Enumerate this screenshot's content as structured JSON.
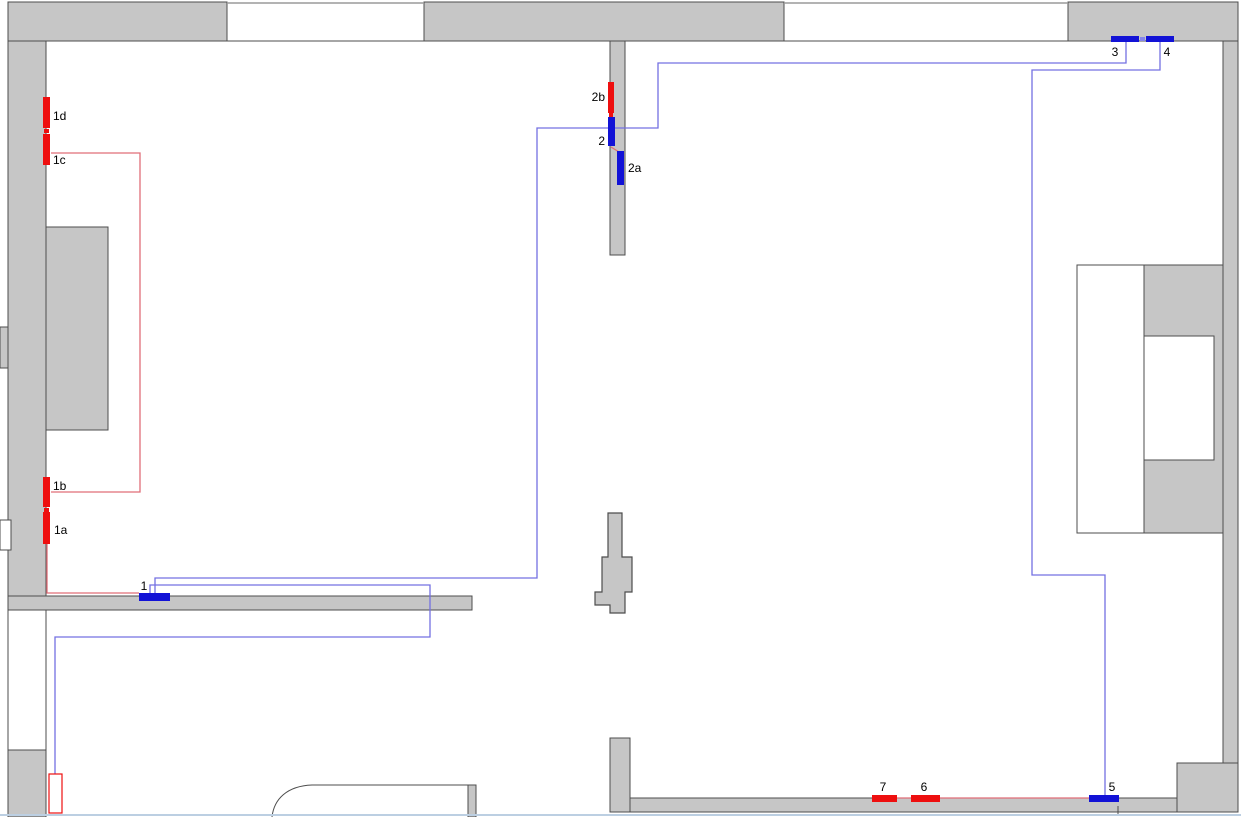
{
  "diagram": {
    "kind": "floor-plan-heating-circuit",
    "colors": {
      "wall_fill": "#c6c6c6",
      "wall_stroke": "#4d4d4d",
      "window_stroke": "#9a9a9a",
      "supply_line_blue": "#7470e2",
      "return_line_red": "#e06e78",
      "marker_red": "#ee0f0f",
      "marker_blue": "#1212d6",
      "tick_light_blue": "#8585ea",
      "label_color": "#000000",
      "viewport_edge": "#bccfe2",
      "white": "#ffffff"
    },
    "walls": [
      {
        "name": "wall-top-left",
        "type": "rect",
        "x": 8,
        "y": 2,
        "w": 219,
        "h": 39,
        "fill": "wall"
      },
      {
        "name": "wall-top-middle",
        "type": "rect",
        "x": 424,
        "y": 2,
        "w": 360,
        "h": 39,
        "fill": "wall"
      },
      {
        "name": "wall-top-right",
        "type": "rect",
        "x": 1068,
        "y": 2,
        "w": 170,
        "h": 39,
        "fill": "wall"
      },
      {
        "name": "wall-left",
        "type": "rect",
        "x": 8,
        "y": 41,
        "w": 38,
        "h": 569,
        "fill": "wall"
      },
      {
        "name": "wall-left-bump",
        "type": "rect",
        "x": 46,
        "y": 227,
        "w": 62,
        "h": 203,
        "fill": "wall"
      },
      {
        "name": "wall-left-pier",
        "type": "rect",
        "x": 0,
        "y": 327,
        "w": 8,
        "h": 41,
        "fill": "wall"
      },
      {
        "name": "wall-bottom-left",
        "type": "rect",
        "x": 8,
        "y": 596,
        "w": 464,
        "h": 14,
        "fill": "wall"
      },
      {
        "name": "wall-left-lower-cavity",
        "type": "rect",
        "x": 8,
        "y": 610,
        "w": 38,
        "h": 140,
        "fill": "white"
      },
      {
        "name": "wall-left-lower",
        "type": "rect",
        "x": 8,
        "y": 750,
        "w": 38,
        "h": 67,
        "fill": "wall"
      },
      {
        "name": "wall-middle-top",
        "type": "rect",
        "x": 610,
        "y": 41,
        "w": 15,
        "h": 214,
        "fill": "wall"
      },
      {
        "name": "wall-middle-bottom",
        "type": "rect",
        "x": 610,
        "y": 738,
        "w": 20,
        "h": 74,
        "fill": "wall"
      },
      {
        "name": "wall-bottom",
        "type": "rect",
        "x": 630,
        "y": 798,
        "w": 547,
        "h": 14,
        "fill": "wall"
      },
      {
        "name": "wall-bottom-right-block",
        "type": "rect",
        "x": 1177,
        "y": 763,
        "w": 61,
        "h": 49,
        "fill": "wall"
      },
      {
        "name": "wall-right",
        "type": "rect",
        "x": 1223,
        "y": 41,
        "w": 15,
        "h": 722,
        "fill": "wall"
      },
      {
        "name": "wall-right-protrusion",
        "type": "rect",
        "x": 1144,
        "y": 265,
        "w": 79,
        "h": 268,
        "fill": "wall"
      },
      {
        "name": "niche-left",
        "type": "rect",
        "x": 1077,
        "y": 265,
        "w": 67,
        "h": 268,
        "fill": "white"
      },
      {
        "name": "niche-inner",
        "type": "rect",
        "x": 1144,
        "y": 336,
        "w": 70,
        "h": 124,
        "fill": "white"
      },
      {
        "name": "left-wall-opening",
        "type": "rect",
        "x": 0,
        "y": 520,
        "w": 11,
        "h": 30,
        "fill": "white"
      },
      {
        "name": "pillar-center",
        "type": "polygon",
        "points": "608,513 622,513 622,557 632,557 632,592 625,592 625,613 610,613 610,605 595,605 595,592 602,592 602,557 608,557"
      },
      {
        "name": "counter-end",
        "type": "rect",
        "x": 468,
        "y": 785,
        "w": 8,
        "h": 32,
        "fill": "wall"
      },
      {
        "name": "counter-edge",
        "type": "path",
        "d": "M272,817 C274,799 287,786 312,785 L468,785"
      }
    ],
    "window_lines": [
      {
        "name": "window-top-1-outer",
        "x1": 227,
        "y1": 3,
        "x2": 424,
        "y2": 3,
        "stroke": "window_stroke",
        "w": 1.5
      },
      {
        "name": "window-top-1-inner",
        "x1": 227,
        "y1": 41,
        "x2": 424,
        "y2": 41,
        "stroke": "wall_stroke",
        "w": 1
      },
      {
        "name": "window-top-2-outer",
        "x1": 784,
        "y1": 3,
        "x2": 1068,
        "y2": 3,
        "stroke": "window_stroke",
        "w": 1.5
      },
      {
        "name": "window-top-2-inner",
        "x1": 784,
        "y1": 41,
        "x2": 1068,
        "y2": 41,
        "stroke": "wall_stroke",
        "w": 1
      },
      {
        "name": "door-tick",
        "x1": 1118,
        "y1": 806,
        "x2": 1118,
        "y2": 814,
        "stroke": "wall_stroke",
        "w": 1
      },
      {
        "name": "viewport-bottom-edge",
        "x1": 0,
        "y1": 815,
        "x2": 1241,
        "y2": 815,
        "stroke": "viewport_edge",
        "w": 2
      }
    ],
    "pipes": [
      {
        "name": "pipe-blue-3-to-1",
        "color": "blue",
        "points": [
          [
            1126,
            42
          ],
          [
            1126,
            63
          ],
          [
            658,
            63
          ],
          [
            658,
            128
          ],
          [
            537,
            128
          ],
          [
            537,
            578
          ],
          [
            155,
            578
          ],
          [
            155,
            593
          ]
        ]
      },
      {
        "name": "pipe-blue-4-to-5",
        "color": "blue",
        "points": [
          [
            1160,
            42
          ],
          [
            1160,
            70
          ],
          [
            1032,
            70
          ],
          [
            1032,
            575
          ],
          [
            1105,
            575
          ],
          [
            1105,
            795
          ]
        ]
      },
      {
        "name": "pipe-blue-1-to-boiler",
        "color": "blue",
        "points": [
          [
            150,
            593
          ],
          [
            150,
            585
          ],
          [
            430,
            585
          ],
          [
            430,
            637
          ],
          [
            55,
            637
          ],
          [
            55,
            774
          ]
        ]
      },
      {
        "name": "pipe-red-1c-to-1b",
        "color": "red",
        "points": [
          [
            51,
            153
          ],
          [
            140,
            153
          ],
          [
            140,
            492
          ],
          [
            51,
            492
          ]
        ]
      },
      {
        "name": "pipe-red-1a-to-1",
        "color": "red",
        "points": [
          [
            47,
            544
          ],
          [
            47,
            593
          ],
          [
            139,
            593
          ]
        ]
      },
      {
        "name": "pipe-red-7-6-to-5",
        "color": "red",
        "points": [
          [
            872,
            798
          ],
          [
            1089,
            798
          ]
        ]
      },
      {
        "name": "pipe-red-2-to-2a",
        "color": "red",
        "points": [
          [
            611,
            147
          ],
          [
            619,
            152
          ]
        ]
      }
    ],
    "connector_ticks": [
      {
        "name": "valve-tick-1d-1c",
        "x": 44,
        "y": 129,
        "w": 5,
        "h": 4,
        "color": "marker_red"
      },
      {
        "name": "valve-tick-1b-1a",
        "x": 44,
        "y": 508,
        "w": 5,
        "h": 4,
        "color": "marker_red"
      },
      {
        "name": "valve-tick-2b-2",
        "x": 609,
        "y": 113,
        "w": 4,
        "h": 4,
        "color": "marker_red"
      },
      {
        "name": "valve-tick-3-4",
        "x": 1140,
        "y": 37,
        "w": 5,
        "h": 4,
        "color": "tick_light_blue"
      }
    ],
    "markers": [
      {
        "id": "1d",
        "label": "1d",
        "color": "red",
        "x": 43,
        "y": 97,
        "w": 7,
        "h": 31,
        "lx": 53,
        "ly": 120,
        "anchor": "start"
      },
      {
        "id": "1c",
        "label": "1c",
        "color": "red",
        "x": 43,
        "y": 134,
        "w": 7,
        "h": 31,
        "lx": 53,
        "ly": 164,
        "anchor": "start"
      },
      {
        "id": "1b",
        "label": "1b",
        "color": "red",
        "x": 43,
        "y": 477,
        "w": 7,
        "h": 30,
        "lx": 53,
        "ly": 490,
        "anchor": "start"
      },
      {
        "id": "1a",
        "label": "1a",
        "color": "red",
        "x": 43,
        "y": 512,
        "w": 7,
        "h": 32,
        "lx": 54,
        "ly": 534,
        "anchor": "start"
      },
      {
        "id": "1",
        "label": "1",
        "color": "blue",
        "x": 139,
        "y": 593,
        "w": 31,
        "h": 8,
        "lx": 144,
        "ly": 590,
        "anchor": "middle"
      },
      {
        "id": "2b",
        "label": "2b",
        "color": "red",
        "x": 608,
        "y": 82,
        "w": 6,
        "h": 31,
        "lx": 605,
        "ly": 101,
        "anchor": "end"
      },
      {
        "id": "2",
        "label": "2",
        "color": "blue",
        "x": 608,
        "y": 117,
        "w": 7,
        "h": 29,
        "lx": 605,
        "ly": 145,
        "anchor": "end"
      },
      {
        "id": "2a",
        "label": "2a",
        "color": "blue",
        "x": 617,
        "y": 151,
        "w": 7,
        "h": 34,
        "lx": 628,
        "ly": 172,
        "anchor": "start"
      },
      {
        "id": "3",
        "label": "3",
        "color": "blue",
        "x": 1111,
        "y": 36,
        "w": 28,
        "h": 6,
        "lx": 1115,
        "ly": 56,
        "anchor": "middle"
      },
      {
        "id": "4",
        "label": "4",
        "color": "blue",
        "x": 1146,
        "y": 36,
        "w": 28,
        "h": 6,
        "lx": 1167,
        "ly": 56,
        "anchor": "middle"
      },
      {
        "id": "5",
        "label": "5",
        "color": "blue",
        "x": 1089,
        "y": 795,
        "w": 30,
        "h": 7,
        "lx": 1112,
        "ly": 791,
        "anchor": "middle"
      },
      {
        "id": "6",
        "label": "6",
        "color": "red",
        "x": 911,
        "y": 795,
        "w": 29,
        "h": 7,
        "lx": 924,
        "ly": 791,
        "anchor": "middle"
      },
      {
        "id": "7",
        "label": "7",
        "color": "red",
        "x": 872,
        "y": 795,
        "w": 25,
        "h": 7,
        "lx": 883,
        "ly": 791,
        "anchor": "middle"
      }
    ],
    "boiler": {
      "name": "boiler-outline",
      "x": 49,
      "y": 774,
      "w": 13,
      "h": 39
    }
  }
}
